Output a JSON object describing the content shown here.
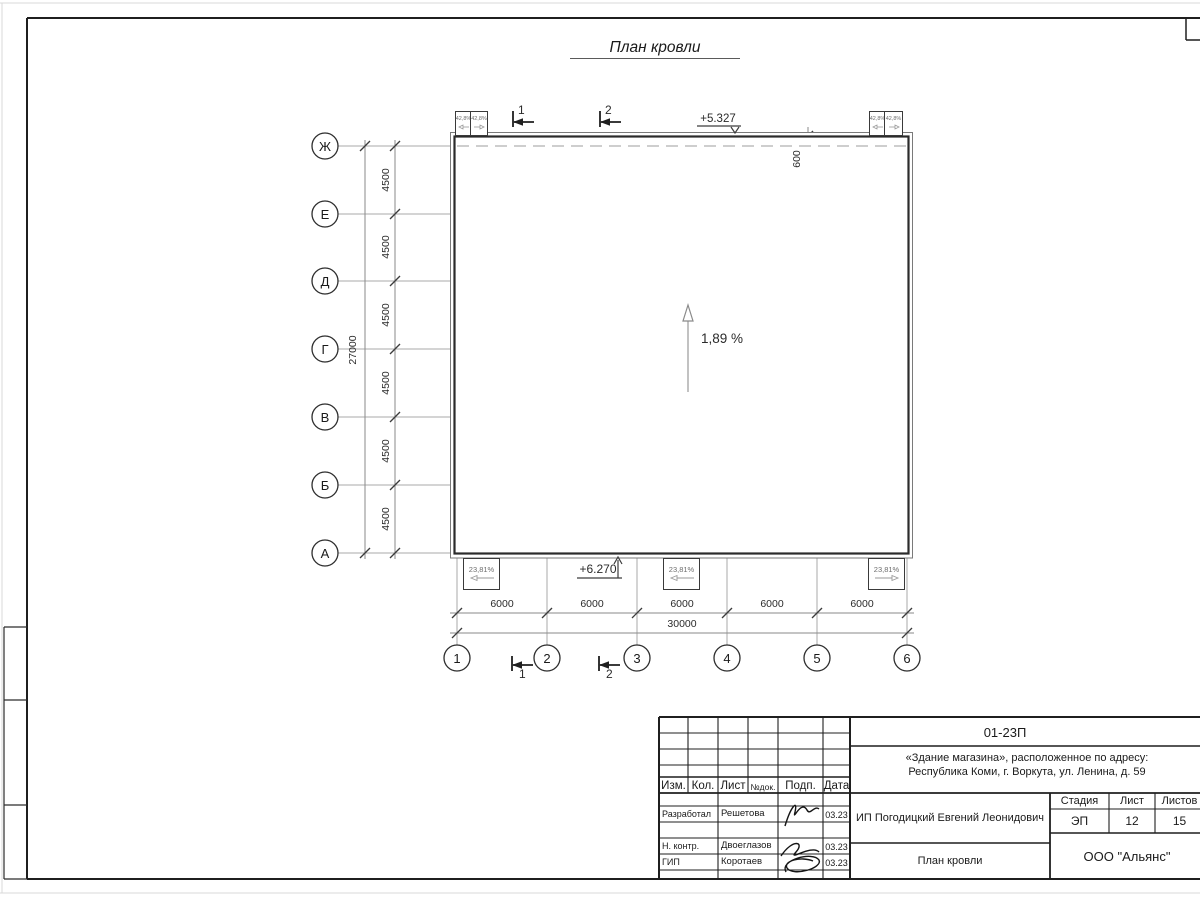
{
  "drawing_title": "План кровли",
  "axes": {
    "rows": [
      "Ж",
      "Е",
      "Д",
      "Г",
      "В",
      "Б",
      "А"
    ],
    "cols": [
      "1",
      "2",
      "3",
      "4",
      "5",
      "6"
    ]
  },
  "dimensions": {
    "row_spacings": [
      "4500",
      "4500",
      "4500",
      "4500",
      "4500",
      "4500"
    ],
    "row_total": "27000",
    "col_spacings": [
      "6000",
      "6000",
      "6000",
      "6000",
      "6000"
    ],
    "col_total": "30000",
    "parapet_offset": "600"
  },
  "elevations": {
    "top": "+5.327",
    "bottom": "+6.270"
  },
  "slope": {
    "main": "1,89 %"
  },
  "drains": {
    "top_left_1": "42,8%",
    "top_left_2": "42,8%",
    "top_right_1": "42,8%",
    "top_right_2": "42,8%",
    "bottom_1": "23,81%",
    "bottom_2": "23,81%",
    "bottom_3": "23,81%"
  },
  "section_marks": {
    "top_1": "1",
    "top_2": "2",
    "bottom_1": "1",
    "bottom_2": "2"
  },
  "title_block": {
    "code": "01-23П",
    "address_line1": "«Здание магазина», расположенное по адресу:",
    "address_line2": "Республика Коми, г. Воркута, ул. Ленина, д. 59",
    "columns": {
      "izm": "Изм.",
      "kol": "Кол.",
      "list": "Лист",
      "ndok": "№док.",
      "podp": "Подп.",
      "data": "Дата"
    },
    "rows": [
      {
        "role": "Разработал",
        "name": "Решетова",
        "date": "03.23"
      },
      {
        "role": "Н. контр.",
        "name": "Двоеглазов",
        "date": "03.23"
      },
      {
        "role": "ГИП",
        "name": "Коротаев",
        "date": "03.23"
      }
    ],
    "client": "ИП Погодицкий Евгений Леонидович",
    "sheet_title": "План кровли",
    "stage_label": "Стадия",
    "sheet_label": "Лист",
    "sheets_label": "Листов",
    "stage": "ЭП",
    "sheet": "12",
    "sheets": "15",
    "company": "ООО \"Альянс\""
  },
  "colors": {
    "line": "#1f1f1f",
    "grid": "#a0a0a0",
    "dashed": "#bdbdbd"
  }
}
